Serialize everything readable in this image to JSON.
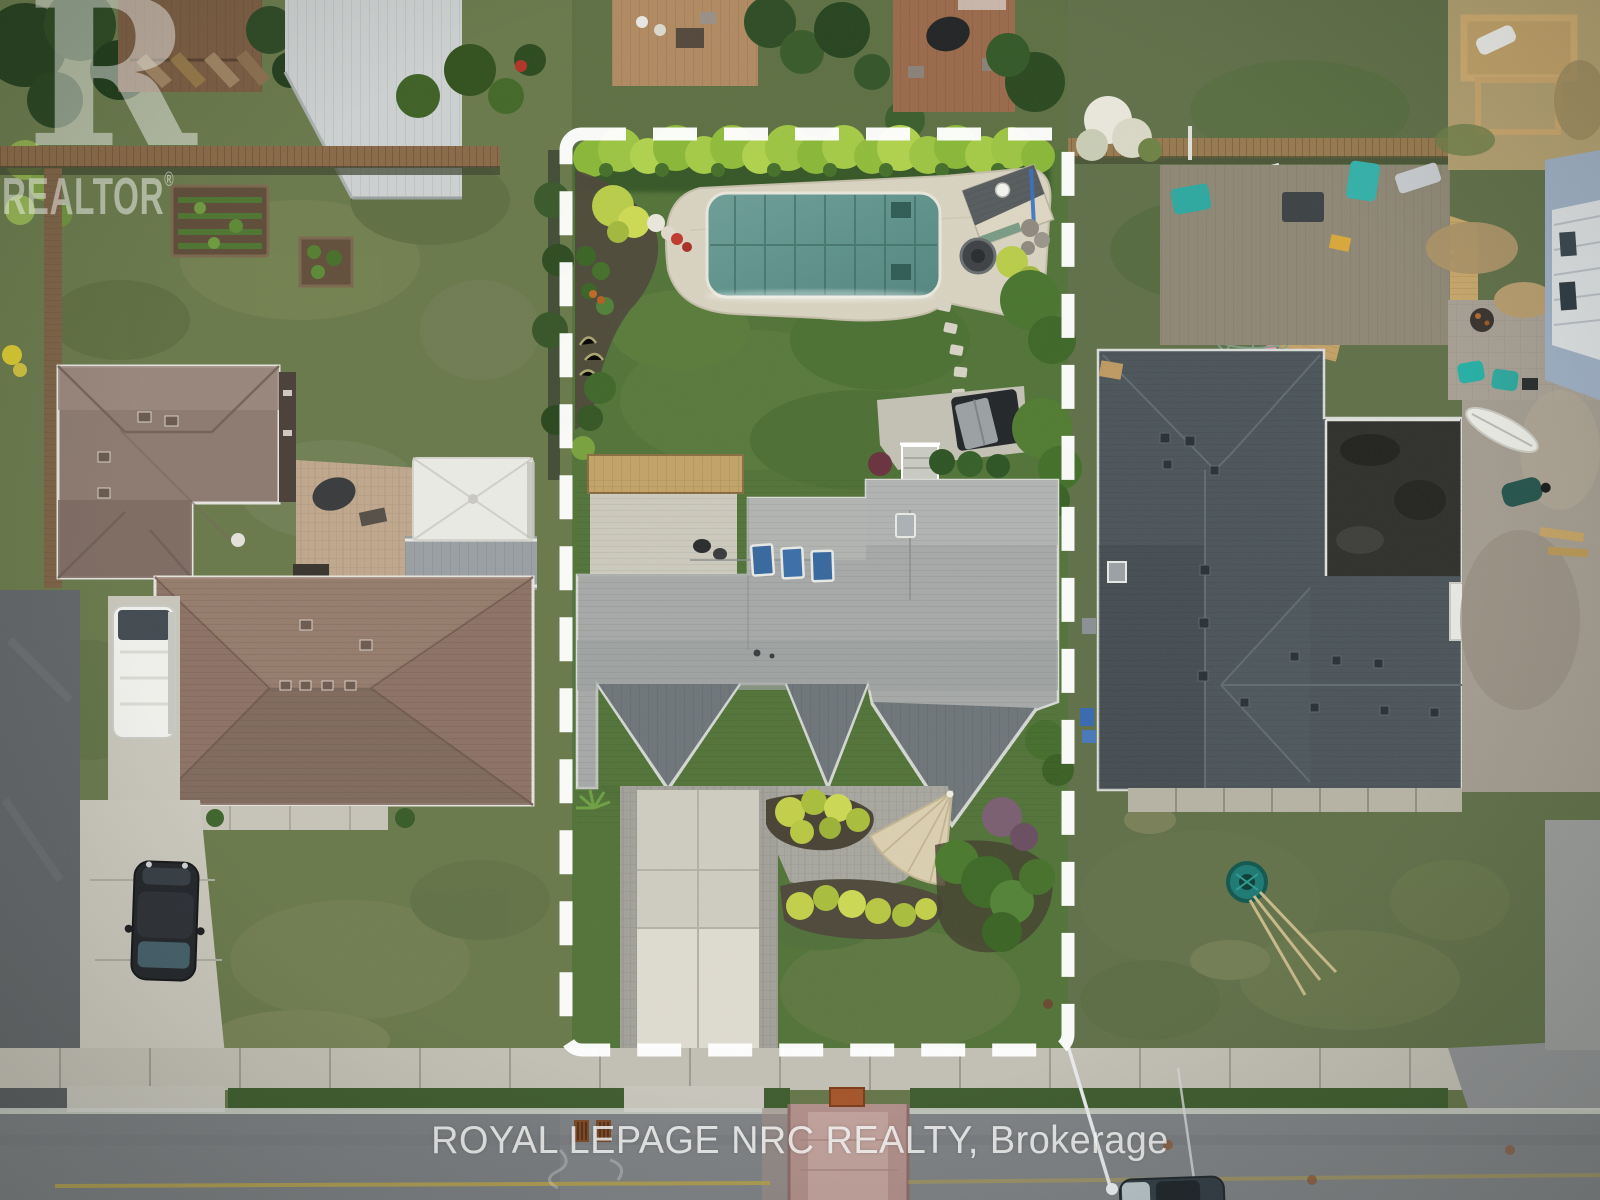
{
  "meta": {
    "kind": "aerial-drone-real-estate-photo",
    "width_px": 1600,
    "height_px": 1200,
    "description": "Top-down aerial photo of a suburban property outlined with a white dashed boundary; backyard with covered in-ground pool, pool shed, large gray-roofed house, paver driveway; neighboring houses left and right, street with sidewalk at bottom."
  },
  "watermark": {
    "logo_letter": "R",
    "label": "REALTOR",
    "registered": "®"
  },
  "caption": {
    "text": "ROYAL LEPAGE NRC REALTY, Brokerage"
  },
  "boundary": {
    "style": "dashed",
    "color": "#ffffff",
    "stroke_width": 13,
    "dash": 44,
    "gap": 27
  },
  "palette": {
    "subject_roof": "#a6a9a7",
    "subject_gable": "#6e767a",
    "skylight_blue": "#38699e",
    "pool_cover_teal": "#5f928c",
    "pool_deck": "#d8d3c1",
    "hedge_green": "#a3c84a",
    "backyard_lawn": "#53743a",
    "driveway_concrete": "#cfccc1",
    "umbrella_beige": "#dbcfb0",
    "left_house_roof": "#8d7b71",
    "gazebo_white": "#eaeae4",
    "white_van": "#eff0ec",
    "black_car": "#24272b",
    "right_house_roof": "#4d565b",
    "right_flat_roof": "#31312e",
    "round_pool_blue": "#3f7fc4",
    "wood_deck_tan": "#c7a76c",
    "road_asphalt": "#7f8285",
    "sidewalk": "#c2bfb4",
    "brick_apron_pink": "#b18f8a",
    "lane_line_yellow": "#b5a14a"
  },
  "scene_objects": [
    "dashed property boundary",
    "cedar hedge row",
    "covered rectangular pool",
    "pool shed with chimney",
    "fire table",
    "stepping stone path",
    "hot tub on pad",
    "gray shingle house with three blue skylights",
    "pergola patio",
    "paver driveway",
    "shade umbrella",
    "gold shrub beds",
    "left neighbor taupe hip-roof houses",
    "white gazebo",
    "white van",
    "black car",
    "right neighbor charcoal roof house",
    "round above-ground pool with blue cover",
    "geodesic climbing dome",
    "teal hose reel",
    "sidewalk",
    "road with yellow center line",
    "pink brick road apron",
    "street light pole",
    "parked car at curb"
  ]
}
